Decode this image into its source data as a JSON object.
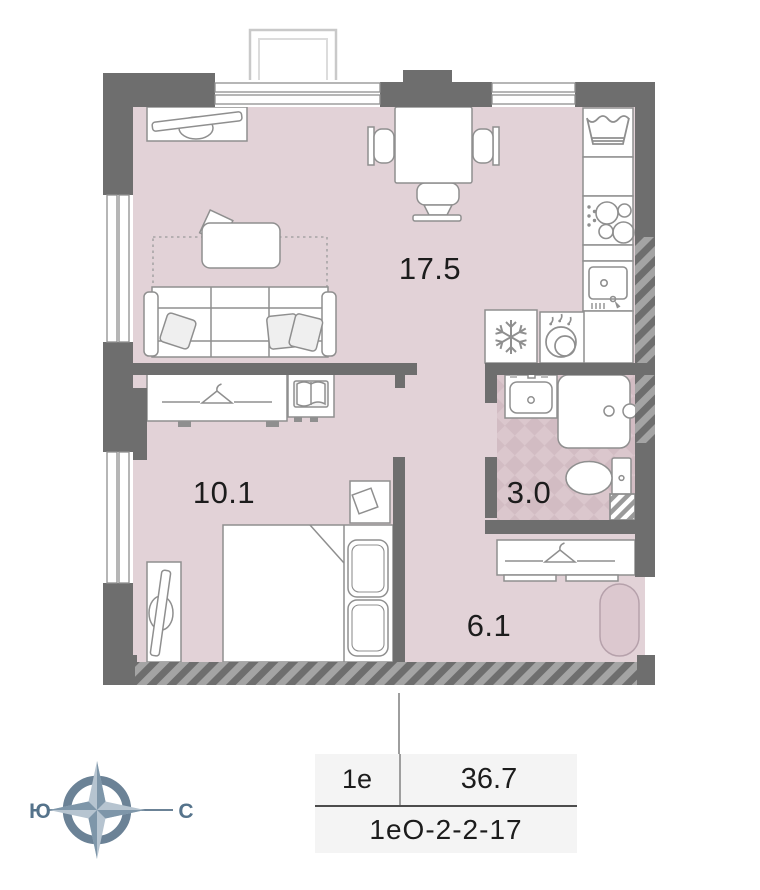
{
  "plan": {
    "rooms": [
      {
        "name": "living-room-kitchen",
        "area": "17.5"
      },
      {
        "name": "bedroom",
        "area": "10.1"
      },
      {
        "name": "bathroom",
        "area": "3.0"
      },
      {
        "name": "hallway",
        "area": "6.1"
      }
    ],
    "icons": [
      "tv-icon",
      "sofa",
      "coffee-table",
      "dotted-rug",
      "dining-table",
      "chair",
      "washing-machine-icon",
      "cooktop-icon",
      "kitchen-sink-icon",
      "fridge-snowflake-icon",
      "pot-steam-icon",
      "bath-sink-icon",
      "shower-icon",
      "toilet-icon",
      "shaft-hatch",
      "hanger-icon",
      "book-icon",
      "nightstand",
      "double-bed",
      "pillow",
      "tv-stand",
      "floor-mat"
    ]
  },
  "compass": {
    "south": "Ю",
    "north": "С"
  },
  "info_table": {
    "plan_type": "1е",
    "total_area": "36.7",
    "unit_code": "1еО-2-2-17"
  },
  "colors": {
    "wall": "#6e6e6e",
    "floor": "#e2d2d7",
    "bath_tile_light": "#dbc7cd",
    "bath_tile_dark": "#d2bcc3",
    "furniture_outline": "#8f8f8f",
    "compass": "#6b8296",
    "table_bg": "#f4f4f4",
    "text": "#1c1c1c"
  }
}
